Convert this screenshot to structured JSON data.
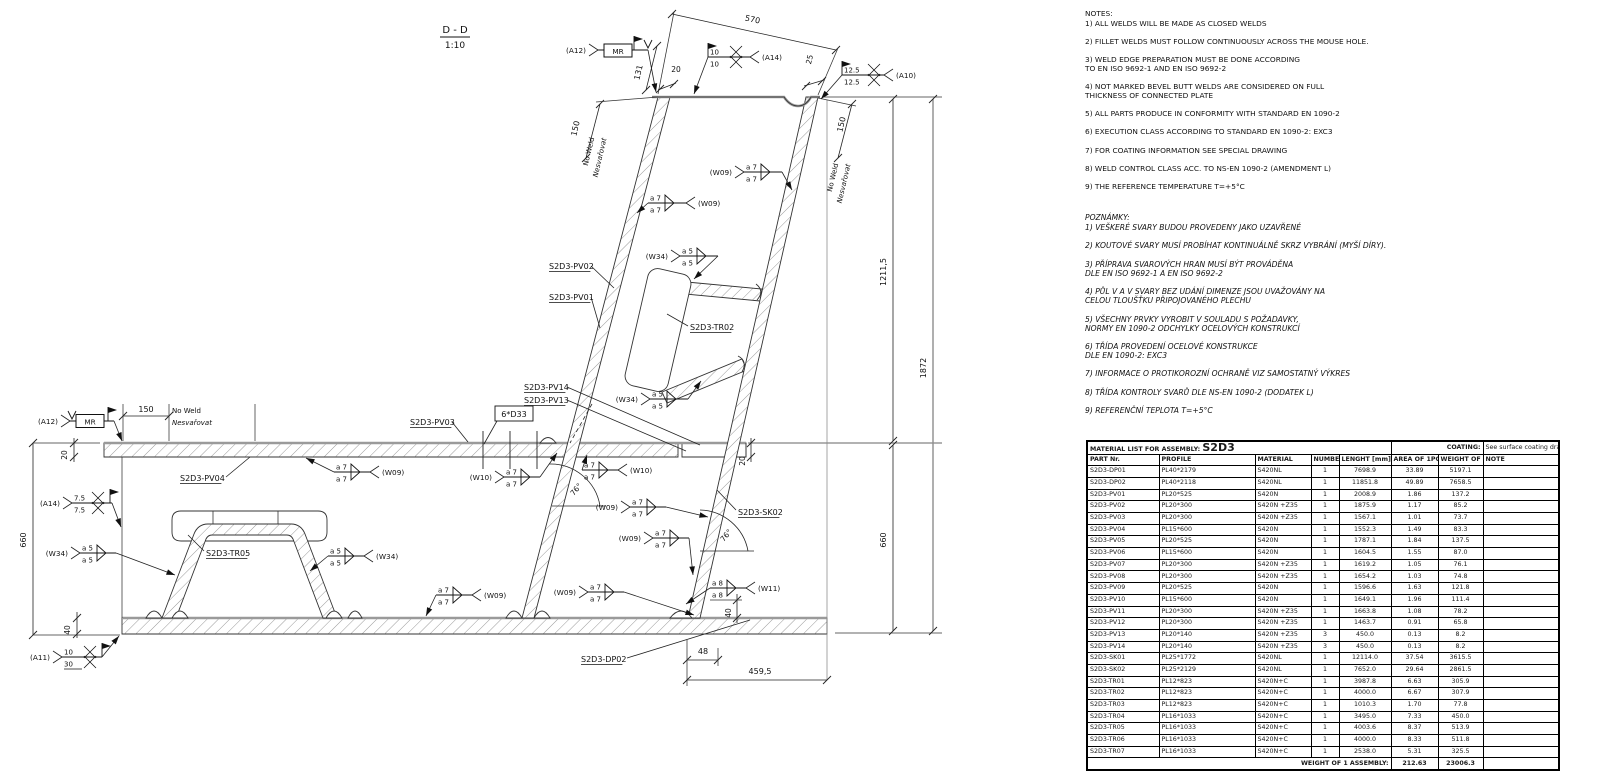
{
  "section": {
    "title": "D - D",
    "scale": "1:10"
  },
  "notes_en": {
    "heading": "NOTES:",
    "items": [
      "1) ALL WELDS WILL BE MADE AS CLOSED WELDS",
      "2) FILLET WELDS MUST FOLLOW CONTINUOUSLY ACROSS THE MOUSE HOLE.",
      "3) WELD EDGE PREPARATION MUST BE DONE ACCORDING\nTO EN ISO 9692-1 AND EN ISO 9692-2",
      "4) NOT MARKED BEVEL BUTT WELDS ARE CONSIDERED ON FULL\nTHICKNESS OF CONNECTED PLATE",
      "5) ALL PARTS PRODUCE IN CONFORMITY WITH STANDARD EN 1090-2",
      "6) EXECUTION CLASS ACCORDING TO STANDARD EN 1090-2: EXC3",
      "7) FOR COATING INFORMATION SEE SPECIAL DRAWING",
      "8) WELD CONTROL CLASS ACC. TO NS-EN 1090-2 (AMENDMENT L)",
      "9) THE REFERENCE TEMPERATURE T=+5°C"
    ]
  },
  "notes_cz": {
    "heading": "POZNÁMKY:",
    "items": [
      "1) VEŠKERÉ SVARY BUDOU PROVEDENY JAKO UZAVŘENÉ",
      "2) KOUTOVÉ SVARY MUSÍ PROBÍHAT KONTINUÁLNĚ SKRZ VYBRÁNÍ (MYŠÍ DÍRY).",
      "3) PŘÍPRAVA SVAROVÝCH HRAN MUSÍ BÝT PROVÁDĚNA\nDLE EN ISO 9692-1 A EN ISO 9692-2",
      "4) PŮL V A V SVARY BEZ UDÁNÍ DIMENZE JSOU UVAŽOVÁNY NA\nCELOU TLOUŠŤKU PŘIPOJOVANÉHO PLECHU",
      "5) VŠECHNY PRVKY VYROBIT V SOULADU S POŽADAVKY,\nNORMY EN 1090-2 ODCHYLKY OCELOVÝCH KONSTRUKCÍ",
      "6) TŘÍDA PROVEDENÍ OCELOVÉ KONSTRUKCE\nDLE EN 1090-2: EXC3",
      "7) INFORMACE O PROTIKOROZNÍ OCHRANĚ VIZ SAMOSTATNÝ VÝKRES",
      "8) TŘÍDA KONTROLY SVARŮ DLE NS-EN 1090-2 (DODATEK L)",
      "9) REFERENČNÍ TEPLOTA T=+5°C"
    ]
  },
  "material_table": {
    "title_label": "MATERIAL LIST FOR ASSEMBLY:",
    "assembly": "S2D3",
    "coating_label": "COATING:",
    "coating_value": "See surface coating drawing",
    "columns": [
      "PART Nr.",
      "PROFILE",
      "MATERIAL",
      "NUMBER",
      "LENGHT [mm]",
      "AREA\nOF 1PCS (m2)",
      "WEIGHT\nOF 1PCS (kg)",
      "NOTE"
    ],
    "rows": [
      [
        "S2D3-DP01",
        "PL40*2179",
        "S420NL",
        "1",
        "7698.9",
        "33.89",
        "5197.1",
        ""
      ],
      [
        "S2D3-DP02",
        "PL40*2118",
        "S420NL",
        "1",
        "11851.8",
        "49.89",
        "7658.5",
        ""
      ],
      [
        "S2D3-PV01",
        "PL20*525",
        "S420N",
        "1",
        "2008.9",
        "1.86",
        "137.2",
        ""
      ],
      [
        "S2D3-PV02",
        "PL20*300",
        "S420N +Z35",
        "1",
        "1875.9",
        "1.17",
        "85.2",
        ""
      ],
      [
        "S2D3-PV03",
        "PL20*300",
        "S420N +Z35",
        "1",
        "1567.1",
        "1.01",
        "73.7",
        ""
      ],
      [
        "S2D3-PV04",
        "PL15*600",
        "S420N",
        "1",
        "1552.3",
        "1.49",
        "83.3",
        ""
      ],
      [
        "S2D3-PV05",
        "PL20*525",
        "S420N",
        "1",
        "1787.1",
        "1.84",
        "137.5",
        ""
      ],
      [
        "S2D3-PV06",
        "PL15*600",
        "S420N",
        "1",
        "1604.5",
        "1.55",
        "87.0",
        ""
      ],
      [
        "S2D3-PV07",
        "PL20*300",
        "S420N +Z35",
        "1",
        "1619.2",
        "1.05",
        "76.1",
        ""
      ],
      [
        "S2D3-PV08",
        "PL20*300",
        "S420N +Z35",
        "1",
        "1654.2",
        "1.03",
        "74.8",
        ""
      ],
      [
        "S2D3-PV09",
        "PL20*525",
        "S420N",
        "1",
        "1596.6",
        "1.63",
        "121.8",
        ""
      ],
      [
        "S2D3-PV10",
        "PL15*600",
        "S420N",
        "1",
        "1649.1",
        "1.96",
        "111.4",
        ""
      ],
      [
        "S2D3-PV11",
        "PL20*300",
        "S420N +Z35",
        "1",
        "1663.8",
        "1.08",
        "78.2",
        ""
      ],
      [
        "S2D3-PV12",
        "PL20*300",
        "S420N +Z35",
        "1",
        "1463.7",
        "0.91",
        "65.8",
        ""
      ],
      [
        "S2D3-PV13",
        "PL20*140",
        "S420N +Z35",
        "3",
        "450.0",
        "0.13",
        "8.2",
        ""
      ],
      [
        "S2D3-PV14",
        "PL20*140",
        "S420N +Z35",
        "3",
        "450.0",
        "0.13",
        "8.2",
        ""
      ],
      [
        "S2D3-SK01",
        "PL25*1772",
        "S420NL",
        "1",
        "12114.0",
        "37.54",
        "3615.5",
        ""
      ],
      [
        "S2D3-SK02",
        "PL25*2129",
        "S420NL",
        "1",
        "7652.0",
        "29.64",
        "2861.5",
        ""
      ],
      [
        "S2D3-TR01",
        "PL12*823",
        "S420N+C",
        "1",
        "3987.8",
        "6.63",
        "305.9",
        ""
      ],
      [
        "S2D3-TR02",
        "PL12*823",
        "S420N+C",
        "1",
        "4000.0",
        "6.67",
        "307.9",
        ""
      ],
      [
        "S2D3-TR03",
        "PL12*823",
        "S420N+C",
        "1",
        "1010.3",
        "1.70",
        "77.8",
        ""
      ],
      [
        "S2D3-TR04",
        "PL16*1033",
        "S420N+C",
        "1",
        "3495.0",
        "7.33",
        "450.0",
        ""
      ],
      [
        "S2D3-TR05",
        "PL16*1033",
        "S420N+C",
        "1",
        "4003.6",
        "8.37",
        "513.9",
        ""
      ],
      [
        "S2D3-TR06",
        "PL16*1033",
        "S420N+C",
        "1",
        "4000.0",
        "8.33",
        "511.8",
        ""
      ],
      [
        "S2D3-TR07",
        "PL16*1033",
        "S420N+C",
        "1",
        "2538.0",
        "5.31",
        "325.5",
        ""
      ]
    ],
    "footer": {
      "label": "WEIGHT OF 1 ASSEMBLY:",
      "area": "212.63",
      "weight": "23006.3"
    }
  },
  "drawing": {
    "part_labels": [
      {
        "id": "pv02",
        "text": "S2D3-PV02"
      },
      {
        "id": "pv01",
        "text": "S2D3-PV01"
      },
      {
        "id": "tr02",
        "text": "S2D3-TR02"
      },
      {
        "id": "pv14",
        "text": "S2D3-PV14"
      },
      {
        "id": "pv13",
        "text": "S2D3-PV13"
      },
      {
        "id": "pv03",
        "text": "S2D3-PV03"
      },
      {
        "id": "pv04",
        "text": "S2D3-PV04"
      },
      {
        "id": "tr05",
        "text": "S2D3-TR05"
      },
      {
        "id": "sk02",
        "text": "S2D3-SK02"
      },
      {
        "id": "dp02",
        "text": "S2D3-DP02"
      }
    ],
    "holes_label": "6*D33",
    "welds": [
      {
        "id": "a12t",
        "tag": "(A12)",
        "top": "",
        "bottom": "",
        "sym": "v",
        "box": "MR"
      },
      {
        "id": "a14t",
        "tag": "(A14)",
        "top": "10",
        "bottom": "10",
        "sym": "x"
      },
      {
        "id": "a10",
        "tag": "(A10)",
        "top": "12.5",
        "bottom": "12.5",
        "sym": "x"
      },
      {
        "id": "w09a",
        "tag": "(W09)",
        "top": "a 7",
        "bottom": "a 7",
        "sym": "fillet"
      },
      {
        "id": "w09b",
        "tag": "(W09)",
        "top": "a 7",
        "bottom": "a 7",
        "sym": "fillet"
      },
      {
        "id": "w34a",
        "tag": "(W34)",
        "top": "a 5",
        "bottom": "a 5",
        "sym": "fillet"
      },
      {
        "id": "w34b",
        "tag": "(W34)",
        "top": "a 5",
        "bottom": "a 5",
        "sym": "fillet"
      },
      {
        "id": "a12L",
        "tag": "(A12)",
        "top": "",
        "bottom": "",
        "sym": "v",
        "box": "MR"
      },
      {
        "id": "a14L",
        "tag": "(A14)",
        "top": "7.5",
        "bottom": "7.5",
        "sym": "x"
      },
      {
        "id": "w34L",
        "tag": "(W34)",
        "top": "a 5",
        "bottom": "a 5",
        "sym": "fillet"
      },
      {
        "id": "w34R",
        "tag": "(W34)",
        "top": "a 5",
        "bottom": "a 5",
        "sym": "fillet"
      },
      {
        "id": "w09c",
        "tag": "(W09)",
        "top": "a 7",
        "bottom": "a 7",
        "sym": "fillet"
      },
      {
        "id": "w10a",
        "tag": "(W10)",
        "top": "a 7",
        "bottom": "a 7",
        "sym": "fillet"
      },
      {
        "id": "w10b",
        "tag": "(W10)",
        "top": "a 7",
        "bottom": "a 7",
        "sym": "fillet"
      },
      {
        "id": "w09d",
        "tag": "(W09)",
        "top": "a 7",
        "bottom": "a 7",
        "sym": "fillet"
      },
      {
        "id": "w09e",
        "tag": "(W09)",
        "top": "a 7",
        "bottom": "a 7",
        "sym": "fillet"
      },
      {
        "id": "w11",
        "tag": "(W11)",
        "top": "a 8",
        "bottom": "a 8",
        "sym": "fillet"
      },
      {
        "id": "w09f",
        "tag": "(W09)",
        "top": "a 7",
        "bottom": "a 7",
        "sym": "fillet"
      },
      {
        "id": "w09g",
        "tag": "(W09)",
        "top": "a 7",
        "bottom": "a 7",
        "sym": "fillet"
      },
      {
        "id": "a11",
        "tag": "(A11)",
        "top": "10",
        "bottom": "30",
        "sym": "x"
      }
    ],
    "dims": [
      {
        "id": "d570",
        "text": "570"
      },
      {
        "id": "d131",
        "text": "131"
      },
      {
        "id": "d20t",
        "text": "20"
      },
      {
        "id": "d25",
        "text": "25"
      },
      {
        "id": "d150tl",
        "text": "150"
      },
      {
        "id": "d150tr",
        "text": "150"
      },
      {
        "id": "d150m",
        "text": "150"
      },
      {
        "id": "d1211",
        "text": "1211,5"
      },
      {
        "id": "d1872",
        "text": "1872"
      },
      {
        "id": "d660r",
        "text": "660"
      },
      {
        "id": "d660l",
        "text": "660"
      },
      {
        "id": "d20l",
        "text": "20"
      },
      {
        "id": "d40l",
        "text": "40"
      },
      {
        "id": "d20r",
        "text": "20"
      },
      {
        "id": "d40r",
        "text": "40"
      },
      {
        "id": "d48",
        "text": "48"
      },
      {
        "id": "d459",
        "text": "459,5"
      },
      {
        "id": "d76a",
        "text": "76°"
      },
      {
        "id": "d76b",
        "text": "76°"
      }
    ],
    "no_weld": {
      "line1": "No Weld",
      "line2": "Nesvařovat"
    }
  }
}
